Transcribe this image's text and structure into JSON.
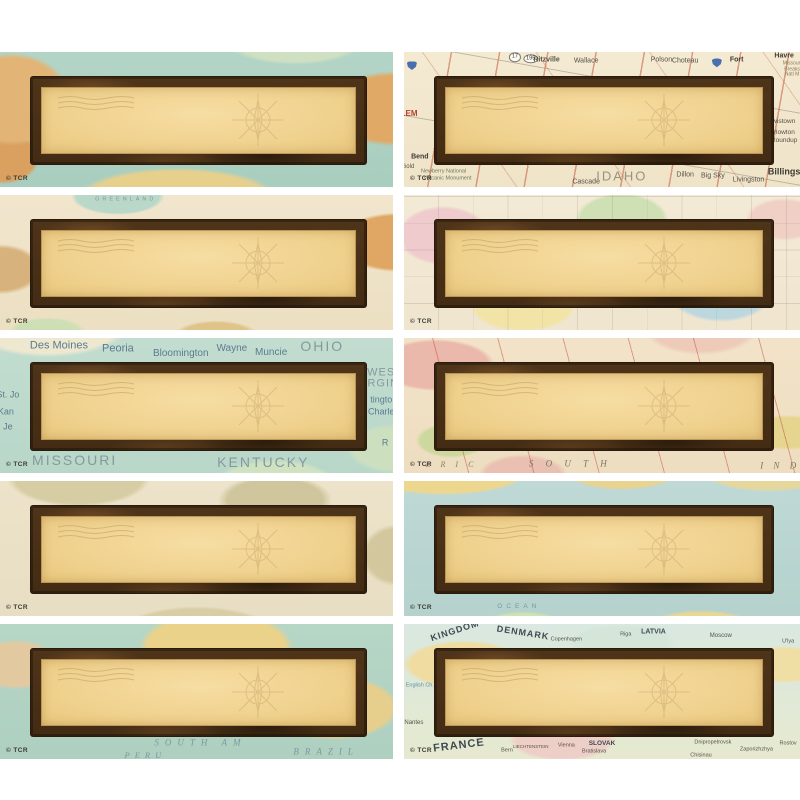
{
  "page": {
    "background": "#ffffff",
    "description": "Grid of 10 blank vintage travel-map name plates, 2 columns x 5 rows"
  },
  "copyright_mark": "© TCR",
  "icons": {
    "postmark-lines-icon": "wavy cancellation lines, top-left of writing panel",
    "compass-rose-icon": "faint compass rose, right side of writing panel",
    "interstate-shield-icon": "blue interstate highway shield"
  },
  "colors": {
    "frame_brown": "#4e3419",
    "frame_dark_edge": "#2a1a0c",
    "panel_tan": "#f0d28f",
    "teal_ocean": "#aed0c0",
    "road_map_cream": "#f2e7ce",
    "road_red": "#c45a3c",
    "page_background": "#ffffff"
  },
  "tiles": [
    {
      "id": "nameplate-1-world-teal",
      "map_style": "world-teal",
      "labels": []
    },
    {
      "id": "nameplate-2-idaho-road-map",
      "map_style": "road-map",
      "labels": [
        {
          "cls": "ishield",
          "icon": "interstate-shield-icon",
          "x": 2,
          "y": 10
        },
        {
          "text": "195",
          "cls": "oval",
          "x": 32,
          "y": 5,
          "size": 5.5
        },
        {
          "text": "17",
          "cls": "oval",
          "x": 28,
          "y": 4,
          "size": 5.5
        },
        {
          "text": "Ritzville",
          "x": 36,
          "y": 6,
          "size": 7,
          "color": "#55524a",
          "bold": true
        },
        {
          "text": "Wallace",
          "x": 46,
          "y": 7,
          "size": 7,
          "color": "#55524a"
        },
        {
          "text": "Polson",
          "x": 65,
          "y": 6,
          "size": 7,
          "color": "#55524a"
        },
        {
          "text": "Choteau",
          "x": 71,
          "y": 7,
          "size": 7,
          "color": "#55524a"
        },
        {
          "cls": "ishield",
          "icon": "interstate-shield-icon",
          "x": 79,
          "y": 8
        },
        {
          "text": "Fort",
          "x": 84,
          "y": 6,
          "size": 7,
          "color": "#3c3a34",
          "bold": true
        },
        {
          "text": "Havre",
          "x": 96,
          "y": 3,
          "size": 7,
          "color": "#3c3a34",
          "bold": true
        },
        {
          "text": "Missouri",
          "x": 98,
          "y": 9,
          "size": 5,
          "color": "#8a7b5a"
        },
        {
          "text": "Breaks",
          "x": 98,
          "y": 13,
          "size": 5,
          "color": "#8a7b5a"
        },
        {
          "text": "Natl M",
          "x": 98,
          "y": 17,
          "size": 5,
          "color": "#8a7b5a"
        },
        {
          "text": "ILEM",
          "x": 1,
          "y": 46,
          "size": 8,
          "color": "#b5432f",
          "bold": true
        },
        {
          "text": "Bend",
          "x": 4,
          "y": 78,
          "size": 7,
          "color": "#3c3a34",
          "bold": true
        },
        {
          "text": "Gold",
          "x": 1,
          "y": 85,
          "size": 6,
          "color": "#55524a"
        },
        {
          "text": "Newberry National",
          "x": 10,
          "y": 89,
          "size": 5.5,
          "color": "#6a7c5a"
        },
        {
          "text": "Volcanic Monument",
          "x": 11,
          "y": 94,
          "size": 5.5,
          "color": "#6a7c5a"
        },
        {
          "text": "Cascade",
          "x": 46,
          "y": 96,
          "size": 7,
          "color": "#55524a"
        },
        {
          "text": "IDAHO",
          "x": 55,
          "y": 92,
          "size": 13,
          "color": "#98937f",
          "ls": 2
        },
        {
          "text": "Dillon",
          "x": 71,
          "y": 91,
          "size": 7,
          "color": "#55524a"
        },
        {
          "text": "Big Sky",
          "x": 78,
          "y": 92,
          "size": 7,
          "color": "#55524a"
        },
        {
          "text": "Livingston",
          "x": 87,
          "y": 95,
          "size": 7,
          "color": "#55524a"
        },
        {
          "text": "Billings",
          "x": 96,
          "y": 89,
          "size": 9,
          "color": "#3c3a34",
          "bold": true
        },
        {
          "text": "Lewistown",
          "x": 95,
          "y": 52,
          "size": 6.5,
          "color": "#55524a"
        },
        {
          "text": "Harlowton",
          "x": 95,
          "y": 60,
          "size": 6.5,
          "color": "#55524a"
        },
        {
          "text": "Roundup",
          "x": 96,
          "y": 66,
          "size": 6.5,
          "color": "#55524a"
        }
      ]
    },
    {
      "id": "nameplate-3-world-cream",
      "map_style": "world-cream",
      "labels": [
        {
          "text": "GREENLAND",
          "x": 32,
          "y": 4,
          "size": 5.5,
          "color": "#86988e",
          "ls": 3
        }
      ]
    },
    {
      "id": "nameplate-4-pastel-states",
      "map_style": "pastel-states",
      "labels": []
    },
    {
      "id": "nameplate-5-midwest",
      "map_style": "midwest-teal",
      "labels": [
        {
          "text": "Des Moines",
          "x": 15,
          "y": 6,
          "size": 11,
          "color": "#5b7b8f"
        },
        {
          "text": "Peoria",
          "x": 30,
          "y": 8,
          "size": 11,
          "color": "#5b7b8f"
        },
        {
          "text": "Bloomington",
          "x": 46,
          "y": 12,
          "size": 10,
          "color": "#5b7b8f"
        },
        {
          "text": "Wayne",
          "x": 59,
          "y": 8,
          "size": 10,
          "color": "#5b7b8f"
        },
        {
          "text": "Muncie",
          "x": 69,
          "y": 11,
          "size": 10,
          "color": "#5b7b8f"
        },
        {
          "text": "OHIO",
          "x": 82,
          "y": 6,
          "size": 14,
          "color": "#87989c",
          "ls": 2
        },
        {
          "text": "WES",
          "x": 97,
          "y": 26,
          "size": 11,
          "color": "#87989c",
          "ls": 1
        },
        {
          "text": "IRGIN",
          "x": 97,
          "y": 34,
          "size": 11,
          "color": "#87989c",
          "ls": 1
        },
        {
          "text": "tingto",
          "x": 97,
          "y": 46,
          "size": 9,
          "color": "#5b7b8f"
        },
        {
          "text": "Charle",
          "x": 97,
          "y": 55,
          "size": 9,
          "color": "#5b7b8f"
        },
        {
          "text": "R",
          "x": 98,
          "y": 78,
          "size": 9,
          "color": "#5b7b8f"
        },
        {
          "text": "St. Jo",
          "x": 2,
          "y": 42,
          "size": 9,
          "color": "#5b7b8f"
        },
        {
          "text": "Kan",
          "x": 1.5,
          "y": 55,
          "size": 9,
          "color": "#5b7b8f"
        },
        {
          "text": "Je",
          "x": 2,
          "y": 66,
          "size": 9,
          "color": "#5b7b8f"
        },
        {
          "text": "MISSOURI",
          "x": 19,
          "y": 90,
          "size": 14,
          "color": "#87989c",
          "ls": 2
        },
        {
          "text": "KENTUCKY",
          "x": 67,
          "y": 92,
          "size": 14,
          "color": "#87989c",
          "ls": 2
        }
      ]
    },
    {
      "id": "nameplate-6-atlas-pink",
      "map_style": "atlas-pink",
      "labels": [
        {
          "text": "E R I C",
          "cls": "serif",
          "x": 12,
          "y": 94,
          "size": 8,
          "color": "#8a8070",
          "ls": 4
        },
        {
          "text": "S O U T H",
          "cls": "serif",
          "x": 42,
          "y": 93,
          "size": 9,
          "color": "#7a7668",
          "ls": 5
        },
        {
          "text": "I N D",
          "cls": "serif",
          "x": 95,
          "y": 95,
          "size": 9,
          "color": "#7a7668",
          "ls": 4
        }
      ]
    },
    {
      "id": "nameplate-7-parchment",
      "map_style": "parchment",
      "labels": []
    },
    {
      "id": "nameplate-8-ocean-world",
      "map_style": "ocean-world",
      "labels": [
        {
          "text": "OCEAN",
          "x": 29,
          "y": 93,
          "size": 6.5,
          "color": "#76989e",
          "ls": 4
        }
      ]
    },
    {
      "id": "nameplate-9-south-america",
      "map_style": "south-america",
      "labels": [
        {
          "text": "SOUTH AM",
          "cls": "serif",
          "x": 51,
          "y": 88,
          "size": 9,
          "color": "#7d96a0",
          "ls": 6
        },
        {
          "text": "PERU",
          "cls": "serif",
          "x": 37,
          "y": 97,
          "size": 8.5,
          "color": "#7d96a0",
          "ls": 5
        },
        {
          "text": "BRAZIL",
          "cls": "serif",
          "x": 83,
          "y": 95,
          "size": 9,
          "color": "#7d96a0",
          "ls": 6
        }
      ]
    },
    {
      "id": "nameplate-10-europe",
      "map_style": "europe-modern",
      "labels": [
        {
          "text": "KINGDOM",
          "x": 13,
          "y": 5,
          "size": 9,
          "color": "#3f4a52",
          "bold": true,
          "rot": -18,
          "ls": 1
        },
        {
          "text": "DENMARK",
          "x": 30,
          "y": 7,
          "size": 9,
          "color": "#3f4a52",
          "bold": true,
          "rot": 9,
          "ls": 1
        },
        {
          "text": "Copenhagen",
          "x": 41,
          "y": 12,
          "size": 5.5,
          "color": "#55524a"
        },
        {
          "text": "Riga",
          "x": 56,
          "y": 8,
          "size": 5.5,
          "color": "#55524a"
        },
        {
          "text": "LATVIA",
          "x": 63,
          "y": 6,
          "size": 7,
          "color": "#3f4a52",
          "bold": true
        },
        {
          "text": "Moscow",
          "x": 80,
          "y": 9,
          "size": 6,
          "color": "#55524a"
        },
        {
          "text": "U'lya",
          "x": 97,
          "y": 13,
          "size": 5.5,
          "color": "#55524a"
        },
        {
          "text": "English Ch.",
          "x": 4,
          "y": 46,
          "size": 5.5,
          "color": "#5b8ca6"
        },
        {
          "text": "Nantes",
          "x": 2.5,
          "y": 73,
          "size": 6,
          "color": "#55524a"
        },
        {
          "text": "FRANCE",
          "x": 14,
          "y": 90,
          "size": 11,
          "color": "#3f4a52",
          "bold": true,
          "rot": -7,
          "ls": 1
        },
        {
          "text": "Bern",
          "x": 26,
          "y": 94,
          "size": 5.5,
          "color": "#55524a"
        },
        {
          "text": "LIECHTENSTEIN",
          "x": 32,
          "y": 91,
          "size": 4.5,
          "color": "#55524a"
        },
        {
          "text": "Vienna",
          "x": 41,
          "y": 90,
          "size": 5.5,
          "color": "#55524a"
        },
        {
          "text": "SLOVAK",
          "x": 50,
          "y": 89,
          "size": 6.5,
          "color": "#3f4a52",
          "bold": true
        },
        {
          "text": "Bratislava",
          "x": 48,
          "y": 95,
          "size": 5.5,
          "color": "#55524a"
        },
        {
          "text": "Chisinau",
          "x": 75,
          "y": 98,
          "size": 5.5,
          "color": "#55524a"
        },
        {
          "text": "Dnipropetrovsk",
          "x": 78,
          "y": 88,
          "size": 5.5,
          "color": "#55524a"
        },
        {
          "text": "Zaporizhzhya",
          "x": 89,
          "y": 93,
          "size": 5.5,
          "color": "#55524a"
        },
        {
          "text": "Rostov",
          "x": 97,
          "y": 89,
          "size": 5.5,
          "color": "#55524a"
        }
      ]
    }
  ]
}
